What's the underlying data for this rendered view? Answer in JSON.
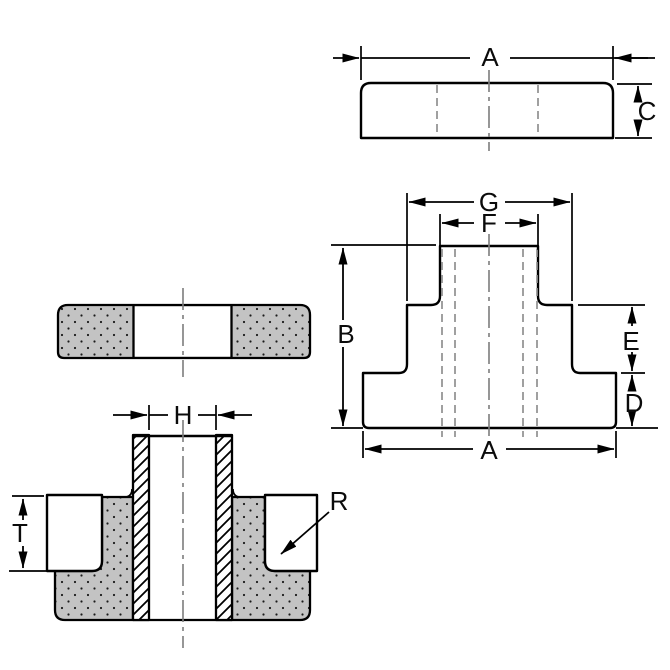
{
  "drawing": {
    "type": "engineering-dimension-diagram",
    "views": {
      "plan_view": {
        "width_label": "A",
        "thickness_label": "C"
      },
      "profile_view": {
        "flange_width_label": "G",
        "neck_width_label": "F",
        "overall_height_label": "B",
        "step_height_label": "E",
        "base_height_label": "D",
        "base_width_label": "A"
      },
      "washer_section_view": {},
      "assembly_section_view": {
        "bore_width_label": "H",
        "plate_thickness_label": "T",
        "corner_radius_label": "R"
      }
    },
    "colors": {
      "background": "#ffffff",
      "outline": "#000000",
      "hidden_line_gray": "#8f8f8f",
      "centerline_gray": "#7d7d7d",
      "rubber_fill_gray": "#c3c3c3"
    }
  }
}
